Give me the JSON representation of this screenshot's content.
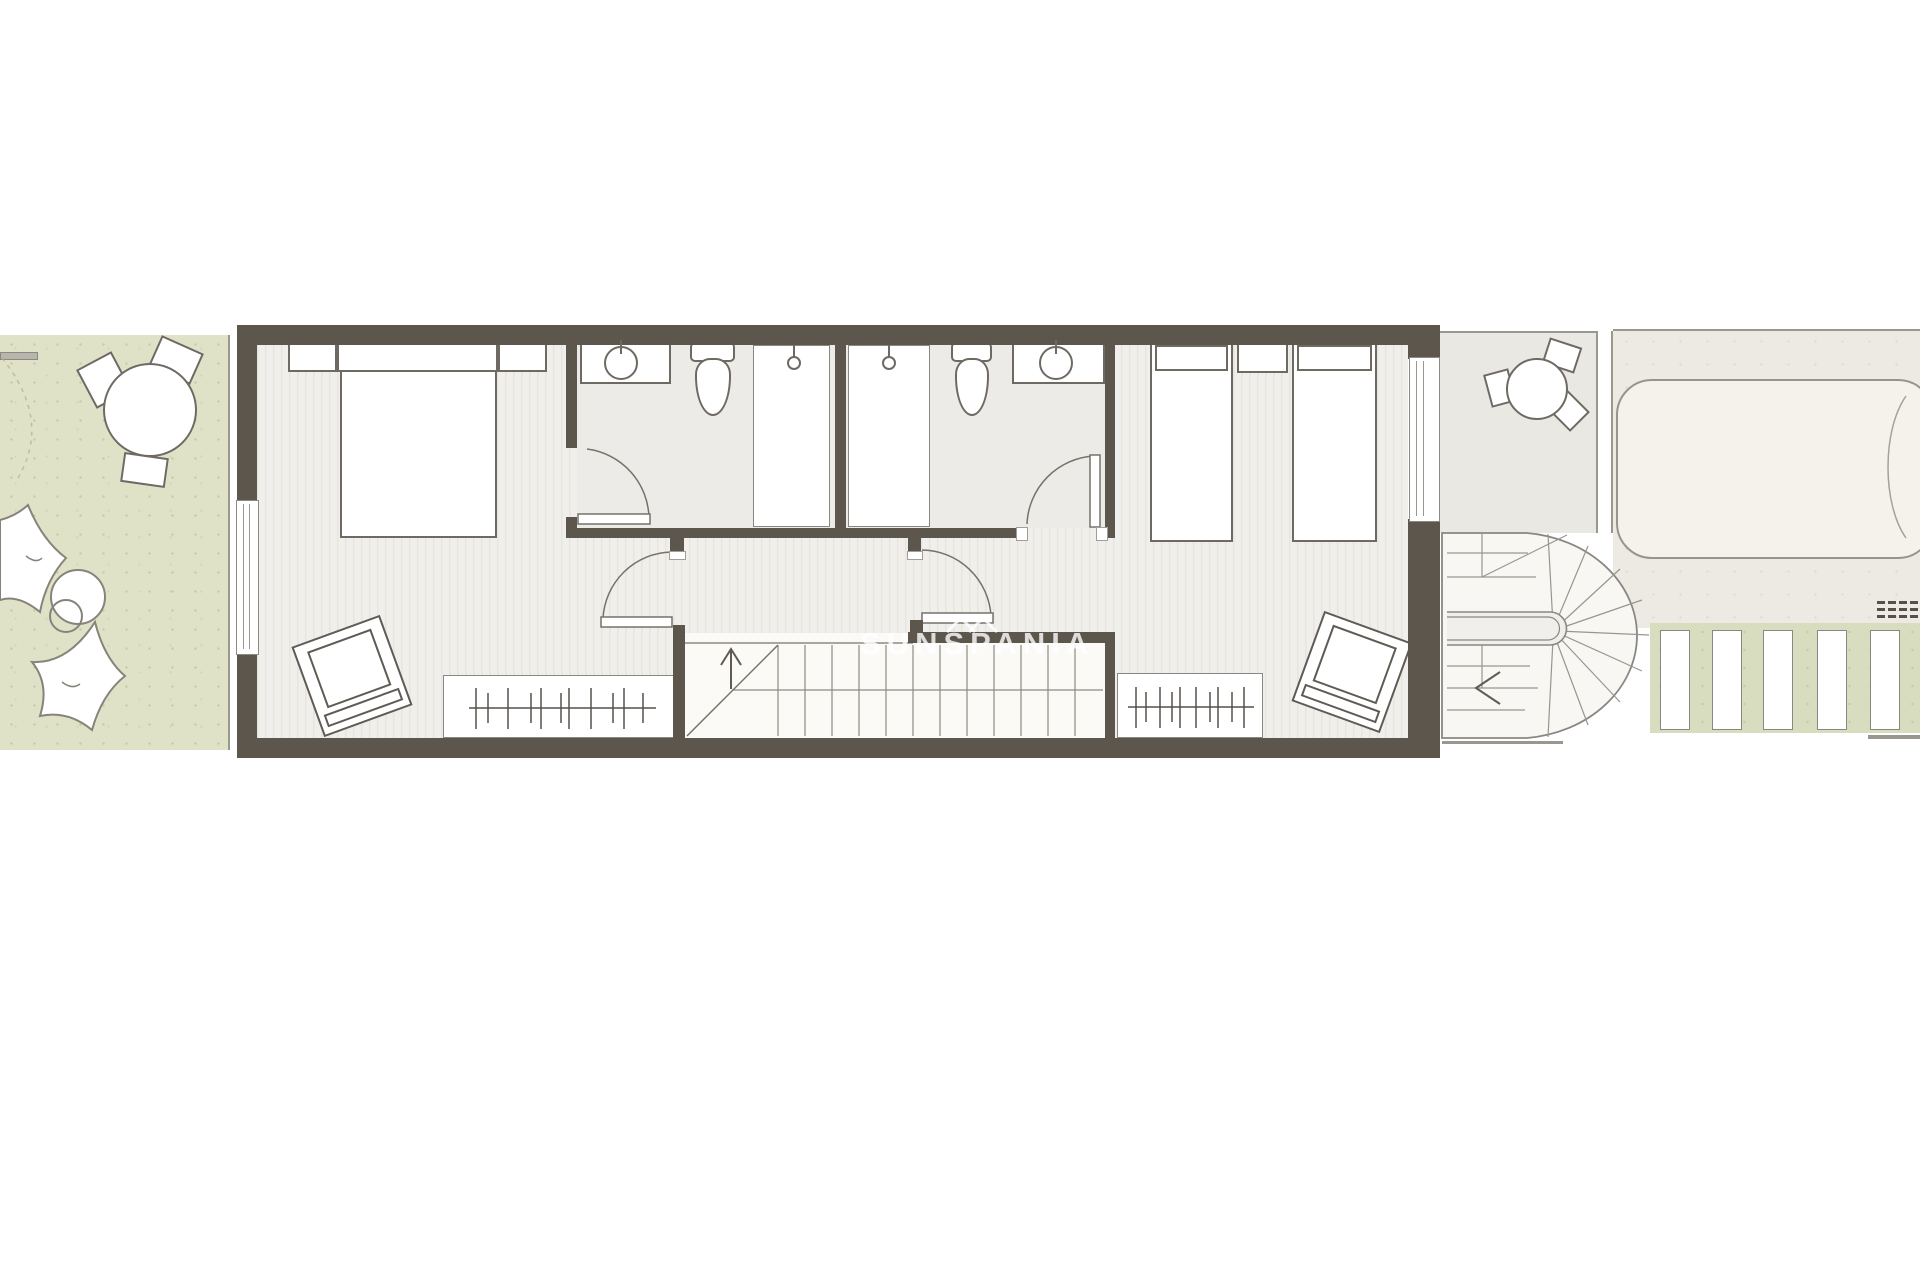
{
  "watermark": {
    "text": "SUNSPANIA",
    "logo": "double-chevron-roof"
  },
  "palette": {
    "background": "#ffffff",
    "wall": "#5d564c",
    "floor_plank": "#f1efeb",
    "floor_stripe": "#e7e5df",
    "bath_floor": "#ecebe7",
    "stair_floor": "#fbfaf7",
    "garden_green": "#dfe2c6",
    "green_strip": "#d9ddbf",
    "terrace": "#eae8e2",
    "deck": "#edeae4",
    "pool": "#f4f2ea",
    "outline": "#6e6a63",
    "thin_line": "#9a978f"
  },
  "inventory": {
    "double_beds": 1,
    "single_beds": 2,
    "nightstands": 3,
    "wardrobes": 2,
    "armchairs": 2,
    "bathrooms": 2,
    "toilets": 2,
    "washbasins": 2,
    "showers": 2,
    "interior_staircases": 1,
    "exterior_curved_staircases": 1,
    "swimming_pools": 1,
    "outdoor_table_sets": 2,
    "bean_bags": 2
  }
}
